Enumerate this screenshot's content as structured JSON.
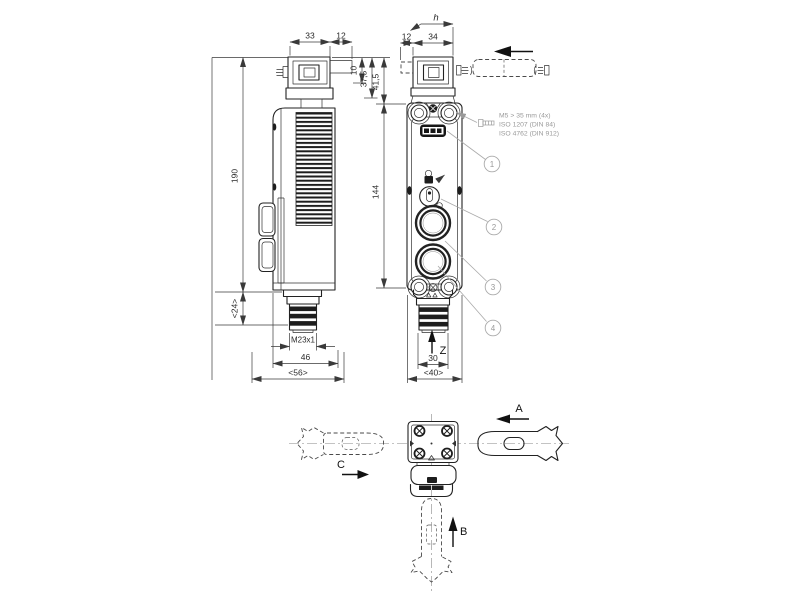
{
  "dimensions": {
    "d33": "33",
    "d12_side": "12",
    "d12_front": "12",
    "d34": "34",
    "dh": "h",
    "d10": "10",
    "d37_5": "37,5",
    "d41_5": "41,5",
    "d144": "144",
    "d190": "190",
    "d24": "<24>",
    "m23": "M23x1",
    "d46": "46",
    "d56": "<56>",
    "d30": "30",
    "d40": "<40>"
  },
  "labels": {
    "a": "A",
    "b": "B",
    "c": "C",
    "z": "Z"
  },
  "callouts": {
    "c1": "1",
    "c2": "2",
    "c3": "3",
    "c4": "4"
  },
  "mounting_note": {
    "line1": "M5 > 35 mm (4x)",
    "line2": "ISO 1207 (DIN 84)",
    "line3": "ISO 4762 (DIN 912)"
  },
  "colors": {
    "line": "#222222",
    "dim": "#3a3a3a",
    "muted": "#9a9a9a",
    "dark_fill": "#1d1d1d",
    "background": "#ffffff"
  }
}
